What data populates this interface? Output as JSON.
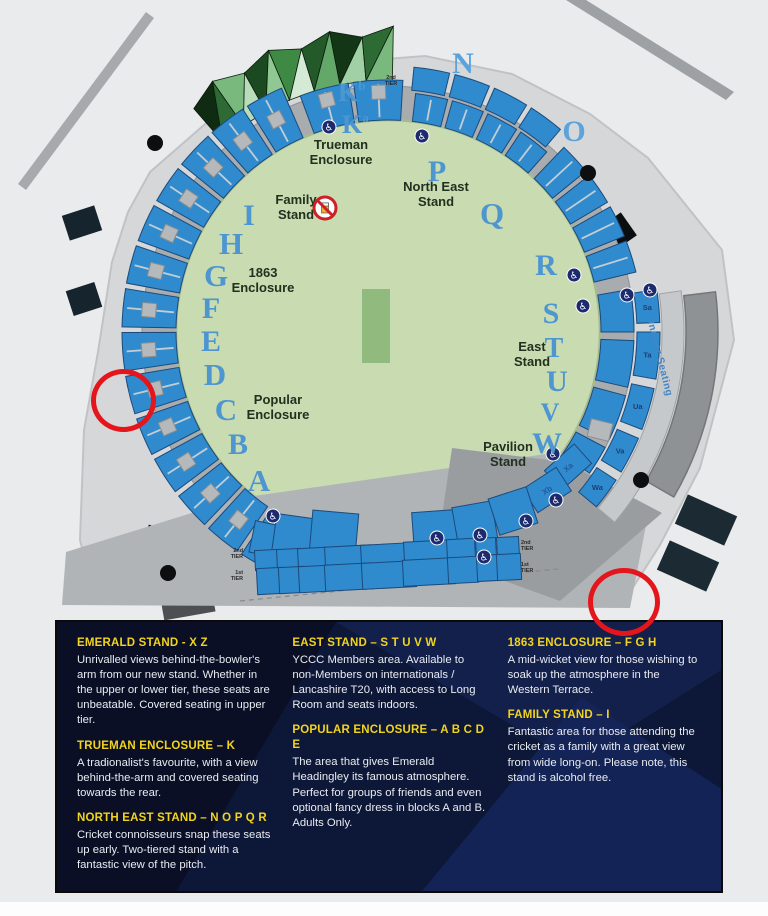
{
  "title": "Emerald Headingley stadium seating map",
  "colors": {
    "stand_blue": "#2f8bcd",
    "stand_stroke": "#1c4a7c",
    "field_green": "#c8dbb1",
    "pitch_green": "#90ba7e",
    "concourse_gray": "#a9acae",
    "apron_gray": "#d6d7d8",
    "plaza_gray": "#b1b4b6",
    "wedge_gray": "#9a9da0",
    "building_gray": "#8f9295",
    "letter_blue": "#4e96d0",
    "letter_blue_light": "#5ba3dc",
    "label_dark": "#22301f",
    "block_label_blue": "#235a9e",
    "panel_bg": "#0d1737",
    "heading_yellow": "#f2d41e",
    "annotation_red": "#e5151c",
    "roof_greens": [
      "#0f2b12",
      "#2e6a33",
      "#7ab97e",
      "#b9dcba",
      "#1c4a20",
      "#8fc893",
      "#3e8a45",
      "#d5ead5",
      "#245a2a",
      "#63a869",
      "#123616",
      "#a2d0a5",
      "#2e6a33",
      "#7ab97e"
    ]
  },
  "map": {
    "center": {
      "cx": 388,
      "cy": 332
    },
    "field_radius": 212,
    "concourse_radius": 246,
    "pitch": {
      "x": 362,
      "y": 289,
      "w": 28,
      "h": 74
    },
    "apron": [
      [
        150,
        172
      ],
      [
        235,
        98
      ],
      [
        320,
        64
      ],
      [
        425,
        56
      ],
      [
        512,
        74
      ],
      [
        590,
        114
      ],
      [
        648,
        158
      ],
      [
        722,
        250
      ],
      [
        734,
        340
      ],
      [
        700,
        468
      ],
      [
        660,
        545
      ],
      [
        625,
        600
      ],
      [
        95,
        600
      ],
      [
        80,
        540
      ],
      [
        84,
        430
      ],
      [
        98,
        352
      ],
      [
        112,
        262
      ],
      [
        128,
        212
      ]
    ],
    "plaza": [
      [
        62,
        605
      ],
      [
        66,
        552
      ],
      [
        240,
        498
      ],
      [
        560,
        452
      ],
      [
        648,
        515
      ],
      [
        630,
        608
      ]
    ],
    "wedge": [
      [
        452,
        448
      ],
      [
        565,
        462
      ],
      [
        662,
        513
      ],
      [
        560,
        601
      ],
      [
        436,
        556
      ]
    ],
    "roads": [
      {
        "name": "road-top-left",
        "pts": [
          [
            18,
            184
          ],
          [
            146,
            12
          ],
          [
            154,
            18
          ],
          [
            26,
            190
          ]
        ],
        "fill": "#a6aaad"
      },
      {
        "name": "road-top-right",
        "pts": [
          [
            566,
            0
          ],
          [
            586,
            0
          ],
          [
            734,
            92
          ],
          [
            726,
            100
          ]
        ],
        "fill": "#9da1a4"
      }
    ],
    "rings": [
      {
        "name": "west-stand",
        "r0": 212,
        "r1": 266,
        "bounds": [
          117,
          124,
          133,
          142.5,
          152,
          161.5,
          171,
          180.5,
          190,
          199.5,
          209,
          218.5,
          228,
          237.5,
          247
        ],
        "aisles": true
      },
      {
        "name": "trueman-k-stand",
        "r0": 212,
        "r1": 252,
        "bounds": [
          249,
          261.5,
          274
        ],
        "aisles": true
      },
      {
        "name": "northeast-inner",
        "r0": 212,
        "r1": 240,
        "bounds": [
          276,
          285,
          294,
          303,
          312
        ],
        "aisles": true
      },
      {
        "name": "northeast-outer",
        "r0": 243,
        "r1": 266,
        "bounds": [
          275,
          284,
          293,
          302,
          311
        ],
        "aisles": false
      },
      {
        "name": "northeast-tail",
        "r0": 212,
        "r1": 255,
        "bounds": [
          313,
          321.5,
          330,
          338.5,
          347
        ],
        "aisles": true
      }
    ],
    "east_blocks": {
      "r0": 213,
      "r1": 246,
      "pairs": [
        [
          350,
          360
        ],
        [
          362,
          373
        ],
        [
          375,
          386
        ],
        [
          388,
          395
        ]
      ]
    },
    "east_strip": {
      "r0": 249,
      "r1": 272,
      "pairs": [
        [
          351,
          358
        ],
        [
          360,
          370
        ],
        [
          372,
          381
        ],
        [
          383,
          391
        ],
        [
          393,
          400
        ]
      ],
      "labels": [
        "Sa",
        "Ta",
        "Ua",
        "Va",
        "Wa"
      ]
    },
    "walkway": {
      "r0": 274,
      "r1": 296,
      "a0": 352,
      "a1": 400
    },
    "building": {
      "r0": 298,
      "r1": 330,
      "a0": 353,
      "a1": 390
    },
    "roof": {
      "a0": 229,
      "a1": 271,
      "step": 6,
      "rInner": 252,
      "rOuter": 296,
      "jag": 10
    },
    "pavilion_blocks": [
      {
        "label": "Xa",
        "cx": 568,
        "cy": 467,
        "w": 40,
        "h": 26,
        "rot": -42
      },
      {
        "label": "Xb",
        "cx": 547,
        "cy": 490,
        "w": 40,
        "h": 28,
        "rot": -33
      }
    ],
    "bottom_rows": [
      {
        "name": "x-row",
        "h": 0,
        "blocks": [
          {
            "label": "Xh",
            "cx": 265,
            "cy": 539,
            "w": 26,
            "h": 32,
            "rot": 12
          },
          {
            "label": "Xg",
            "cx": 293,
            "cy": 536,
            "w": 38,
            "h": 40,
            "rot": 8
          },
          {
            "label": "Xf",
            "cx": 334,
            "cy": 533,
            "w": 46,
            "h": 42,
            "rot": 5
          },
          {
            "label": "Xe",
            "cx": 436,
            "cy": 531,
            "w": 46,
            "h": 40,
            "rot": -4
          },
          {
            "label": "Xd",
            "cx": 475,
            "cy": 524,
            "w": 40,
            "h": 40,
            "rot": -10
          },
          {
            "label": "Xc",
            "cx": 513,
            "cy": 511,
            "w": 40,
            "h": 38,
            "rot": -18
          }
        ]
      },
      {
        "name": "y-row",
        "h": 0,
        "blocks": [
          {
            "label": "Yi",
            "cx": 267,
            "cy": 560,
            "w": 24,
            "h": 20,
            "rot": -3
          },
          {
            "label": "Yh",
            "cx": 289,
            "cy": 559,
            "w": 24,
            "h": 20,
            "rot": -3
          },
          {
            "label": "Yg",
            "cx": 312,
            "cy": 558,
            "w": 28,
            "h": 20,
            "rot": -3
          },
          {
            "label": "Yf",
            "cx": 348,
            "cy": 556,
            "w": 46,
            "h": 20,
            "rot": -3
          },
          {
            "label": "Ye",
            "cx": 387,
            "cy": 554,
            "w": 52,
            "h": 20,
            "rot": -3
          },
          {
            "label": "Yd",
            "cx": 428,
            "cy": 551,
            "w": 48,
            "h": 20,
            "rot": -3
          },
          {
            "label": "Yc",
            "cx": 461,
            "cy": 549,
            "w": 28,
            "h": 20,
            "rot": -3
          },
          {
            "label": "Yb",
            "cx": 486,
            "cy": 548,
            "w": 20,
            "h": 20,
            "rot": -3
          },
          {
            "label": "Ya",
            "cx": 508,
            "cy": 547,
            "w": 22,
            "h": 20,
            "rot": -3
          }
        ]
      },
      {
        "name": "z-row",
        "h": 0,
        "blocks": [
          {
            "label": "Zi",
            "cx": 270,
            "cy": 581,
            "w": 26,
            "h": 26,
            "rot": -3
          },
          {
            "label": "Zh",
            "cx": 292,
            "cy": 580,
            "w": 26,
            "h": 26,
            "rot": -3
          },
          {
            "label": "Zg",
            "cx": 314,
            "cy": 579,
            "w": 30,
            "h": 26,
            "rot": -3
          },
          {
            "label": "Zf",
            "cx": 349,
            "cy": 577,
            "w": 48,
            "h": 26,
            "rot": -3
          },
          {
            "label": "Ze",
            "cx": 389,
            "cy": 575,
            "w": 54,
            "h": 26,
            "rot": -3
          },
          {
            "label": "Zd",
            "cx": 429,
            "cy": 572,
            "w": 52,
            "h": 26,
            "rot": -3
          },
          {
            "label": "Zc",
            "cx": 463,
            "cy": 570,
            "w": 30,
            "h": 26,
            "rot": -3
          },
          {
            "label": "Zb",
            "cx": 488,
            "cy": 568,
            "w": 22,
            "h": 26,
            "rot": -3
          },
          {
            "label": "Za",
            "cx": 509,
            "cy": 567,
            "w": 24,
            "h": 26,
            "rot": -3
          }
        ]
      }
    ],
    "stand_letters": [
      {
        "t": "N",
        "x": 463,
        "y": 73,
        "s": 30,
        "light": true
      },
      {
        "t": "O",
        "x": 574,
        "y": 141,
        "s": 30,
        "light": true
      },
      {
        "t": "P",
        "x": 437,
        "y": 181,
        "s": 30
      },
      {
        "t": "Q",
        "x": 492,
        "y": 224,
        "s": 31
      },
      {
        "t": "R",
        "x": 546,
        "y": 275,
        "s": 30
      },
      {
        "t": "S",
        "x": 551,
        "y": 323,
        "s": 30
      },
      {
        "t": "T",
        "x": 554,
        "y": 357,
        "s": 28
      },
      {
        "t": "U",
        "x": 557,
        "y": 391,
        "s": 30
      },
      {
        "t": "V",
        "x": 550,
        "y": 421,
        "s": 26
      },
      {
        "t": "W",
        "x": 547,
        "y": 453,
        "s": 30
      },
      {
        "t": "I",
        "x": 249,
        "y": 225,
        "s": 30
      },
      {
        "t": "H",
        "x": 231,
        "y": 254,
        "s": 31
      },
      {
        "t": "G",
        "x": 216,
        "y": 286,
        "s": 31
      },
      {
        "t": "F",
        "x": 211,
        "y": 318,
        "s": 30
      },
      {
        "t": "E",
        "x": 211,
        "y": 351,
        "s": 30
      },
      {
        "t": "D",
        "x": 215,
        "y": 385,
        "s": 31
      },
      {
        "t": "C",
        "x": 226,
        "y": 420,
        "s": 31
      },
      {
        "t": "B",
        "x": 238,
        "y": 454,
        "s": 30
      },
      {
        "t": "A",
        "x": 259,
        "y": 491,
        "s": 31
      }
    ],
    "k_labels": [
      {
        "main": "K",
        "sup": "b",
        "x": 338,
        "y": 101
      },
      {
        "main": "K",
        "sup": "a",
        "x": 342,
        "y": 133
      }
    ],
    "area_labels": [
      {
        "id": "trueman-enclosure",
        "lines": [
          "Trueman",
          "Enclosure"
        ],
        "x": 341,
        "y": 149
      },
      {
        "id": "north-east-stand",
        "lines": [
          "North East",
          "Stand"
        ],
        "x": 436,
        "y": 191
      },
      {
        "id": "family-stand",
        "lines": [
          "Family",
          "Stand"
        ],
        "x": 296,
        "y": 204
      },
      {
        "id": "enclosure-1863",
        "lines": [
          "1863",
          "Enclosure"
        ],
        "x": 263,
        "y": 277
      },
      {
        "id": "popular-enclosure",
        "lines": [
          "Popular",
          "Enclosure"
        ],
        "x": 278,
        "y": 404
      },
      {
        "id": "east-stand",
        "lines": [
          "East",
          "Stand"
        ],
        "x": 532,
        "y": 351
      },
      {
        "id": "pavilion-stand",
        "lines": [
          "Pavilion",
          "Stand"
        ],
        "x": 508,
        "y": 451
      }
    ],
    "indoor_seating": {
      "text": "Indoor Seating",
      "x": 648,
      "y": 322,
      "rot": 76
    },
    "tier_labels": [
      {
        "x": 391,
        "y": 79,
        "anchor": "middle",
        "lines": [
          "2nd",
          "TIER"
        ]
      },
      {
        "x": 243,
        "y": 552,
        "anchor": "end",
        "lines": [
          "2nd",
          "TIER"
        ]
      },
      {
        "x": 243,
        "y": 574,
        "anchor": "end",
        "lines": [
          "1st",
          "TIER"
        ]
      },
      {
        "x": 521,
        "y": 544,
        "anchor": "start",
        "lines": [
          "2nd",
          "TIER"
        ]
      },
      {
        "x": 521,
        "y": 566,
        "anchor": "start",
        "lines": [
          "1st",
          "TIER"
        ]
      }
    ],
    "wheelchair_positions": [
      [
        329,
        127
      ],
      [
        422,
        136
      ],
      [
        574,
        275
      ],
      [
        583,
        306
      ],
      [
        627,
        295
      ],
      [
        650,
        290
      ],
      [
        553,
        454
      ],
      [
        556,
        500
      ],
      [
        526,
        521
      ],
      [
        273,
        516
      ],
      [
        437,
        538
      ],
      [
        480,
        535
      ],
      [
        484,
        557
      ]
    ],
    "tree_dots": [
      [
        155,
        143
      ],
      [
        588,
        173
      ],
      [
        641,
        480
      ],
      [
        168,
        573
      ]
    ],
    "buildings": [
      {
        "name": "building-left-1",
        "cx": 82,
        "cy": 223,
        "w": 34,
        "h": 26,
        "rot": -18,
        "fill": "#16242e"
      },
      {
        "name": "building-left-2",
        "cx": 84,
        "cy": 299,
        "w": 30,
        "h": 26,
        "rot": -18,
        "fill": "#16242e"
      },
      {
        "name": "building-right-black",
        "cx": 610,
        "cy": 237,
        "w": 46,
        "h": 28,
        "rot": -35,
        "fill": "#0b0d0f"
      },
      {
        "name": "building-bottom-left-black",
        "cx": 156,
        "cy": 548,
        "w": 28,
        "h": 40,
        "rot": 18,
        "fill": "#0b0d0f"
      },
      {
        "name": "building-bottom-left-gray",
        "cx": 188,
        "cy": 605,
        "w": 52,
        "h": 22,
        "rot": -10,
        "fill": "#4c5053"
      },
      {
        "name": "carpark-right-1",
        "cx": 706,
        "cy": 520,
        "w": 54,
        "h": 32,
        "rot": 24,
        "fill": "#1c2a33"
      },
      {
        "name": "carpark-right-2",
        "cx": 688,
        "cy": 566,
        "w": 54,
        "h": 32,
        "rot": 24,
        "fill": "#1c2a33"
      }
    ],
    "east_square": {
      "cx": 600,
      "cy": 430,
      "w": 22,
      "h": 18,
      "rot": 14
    },
    "no_alcohol_icon": {
      "cx": 325,
      "cy": 208,
      "r": 11
    }
  },
  "panel": {
    "columns": [
      {
        "sections": [
          {
            "heading": "EMERALD STAND - X Z",
            "body": "Unrivalled views behind-the-bowler's arm from our new stand. Whether in the upper or lower tier, these seats are unbeatable. Covered seating in upper tier."
          },
          {
            "heading": "TRUEMAN ENCLOSURE – K",
            "body": "A tradionalist's favourite, with a view behind-the-arm and covered seating towards the rear."
          },
          {
            "heading": "NORTH EAST STAND – N O P Q R",
            "body": "Cricket connoisseurs snap these seats up early. Two-tiered stand with a fantastic view of the pitch."
          }
        ]
      },
      {
        "sections": [
          {
            "heading": "EAST STAND – S T U V W",
            "body": "YCCC Members area. Available to non-Members on internationals / Lancashire T20, with access to Long Room and seats indoors."
          },
          {
            "heading": "POPULAR ENCLOSURE – A B C D E",
            "body": "The area that gives Emerald Headingley its famous atmosphere. Perfect for groups of friends and even optional fancy dress in blocks A and B. Adults Only."
          }
        ]
      },
      {
        "sections": [
          {
            "heading": "1863 ENCLOSURE – F G H",
            "body": "A mid-wicket view for those wishing to soak up the atmosphere in the Western Terrace."
          },
          {
            "heading": "FAMILY STAND – I",
            "body": "Fantastic area for those attending the cricket as a family with a great view from wide long-on. Please note, this stand is alcohol free."
          }
        ]
      }
    ]
  }
}
